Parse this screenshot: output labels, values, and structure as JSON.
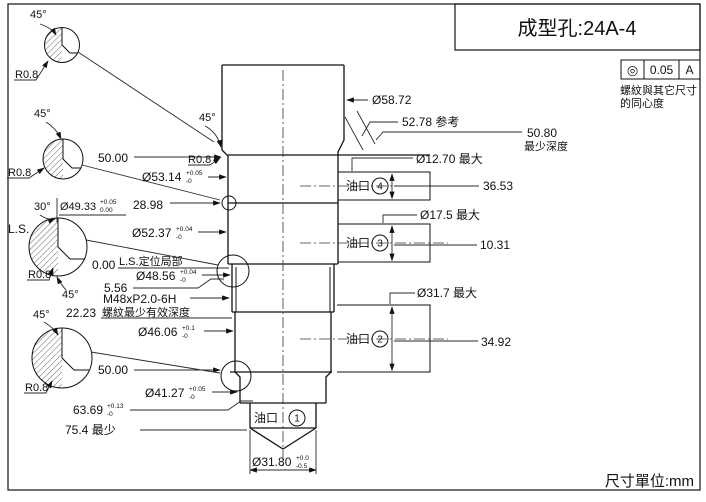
{
  "title_block": {
    "title": "成型孔:24A-4"
  },
  "frame": {
    "units_label": "尺寸單位:mm"
  },
  "fcf": {
    "symbol": "◎",
    "tolerance": "0.05",
    "datum": "A",
    "note_line1": "螺紋與其它尺寸",
    "note_line2": "的同心度"
  },
  "ports": [
    {
      "label": "油口",
      "num": "1"
    },
    {
      "label": "油口",
      "num": "2"
    },
    {
      "label": "油口",
      "num": "3"
    },
    {
      "label": "油口",
      "num": "4"
    }
  ],
  "dims": {
    "d5872": {
      "text": "Ø58.72"
    },
    "d5278": {
      "text": "52.78 参考"
    },
    "d5080": {
      "text": "50.80",
      "sub": "最少深度"
    },
    "d1270": {
      "text": "Ø12.70 最大"
    },
    "d3653": {
      "text": "36.53"
    },
    "d175": {
      "text": "Ø17.5 最大"
    },
    "d1031": {
      "text": "10.31"
    },
    "d317": {
      "text": "Ø31.7 最大"
    },
    "d3492": {
      "text": "34.92"
    },
    "d5000_top": {
      "text": "50.00"
    },
    "d5314": {
      "text": "Ø53.14",
      "tol_top": "+0.05",
      "tol_bot": "-0"
    },
    "d2898": {
      "text": "28.98"
    },
    "d4933": {
      "text": "Ø49.33",
      "tol_top": "+0.05",
      "tol_bot": "0.00"
    },
    "d5237": {
      "text": "Ø52.37",
      "tol_top": "+0.04",
      "tol_bot": "-0"
    },
    "d000": {
      "text": "0.00"
    },
    "ls_local": {
      "text": "L.S.定位局部"
    },
    "d4856": {
      "text": "Ø48.56",
      "tol_top": "+0.04",
      "tol_bot": "-0"
    },
    "d556": {
      "text": "5.56"
    },
    "thread": {
      "text": "M48xP2.0-6H"
    },
    "thread_depth": {
      "text": "螺紋最少有效深度"
    },
    "d2223": {
      "text": "22.23"
    },
    "d4606": {
      "text": "Ø46.06",
      "tol_top": "+0.1",
      "tol_bot": "-0"
    },
    "d5000_bot": {
      "text": "50.00"
    },
    "d4127": {
      "text": "Ø41.27",
      "tol_top": "+0.05",
      "tol_bot": "-0"
    },
    "d6369": {
      "text": "63.69",
      "tol_top": "+0.13",
      "tol_bot": "-0"
    },
    "d754": {
      "text": "75.4 最少"
    },
    "d3180": {
      "text": "Ø31.80",
      "tol_top": "+0.0",
      "tol_bot": "-0.5"
    }
  },
  "annotations": {
    "angle45": "45°",
    "angle30": "30°",
    "r08": "R0.8",
    "ls": "L.S."
  }
}
